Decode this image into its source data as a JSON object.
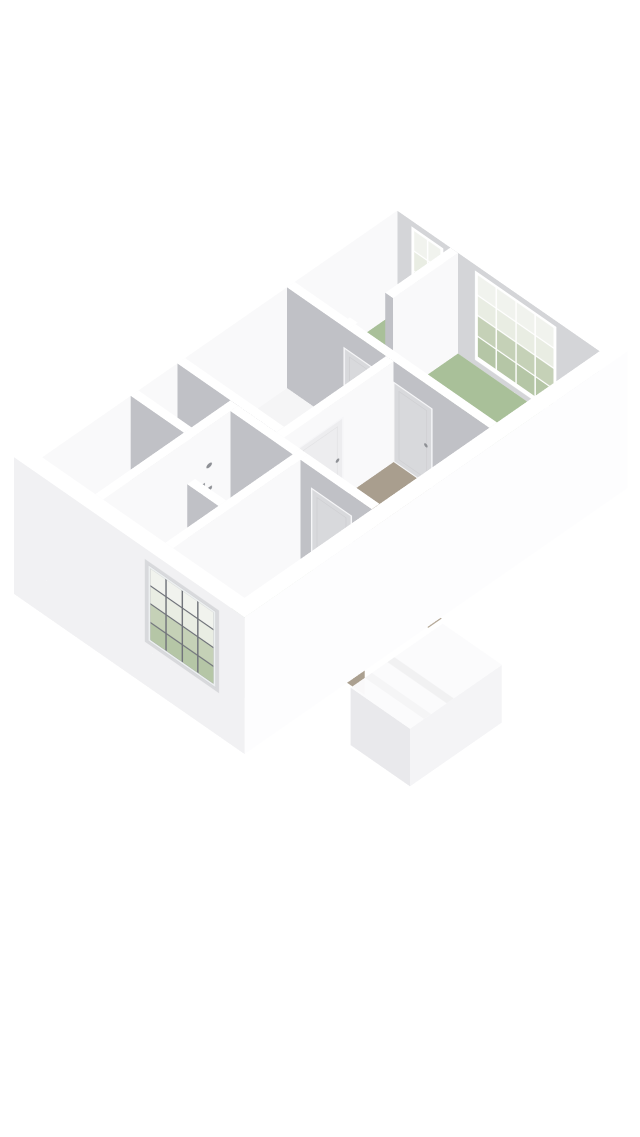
{
  "scene": {
    "type": "3d-floorplan-isometric-render",
    "background": "#ffffff",
    "level": "upper-floor"
  },
  "palette": {
    "page_bg": "#ffffff",
    "floor_white": "#f5f5f6",
    "floor_green": "#a9c099",
    "floor_beige": "#a99e8e",
    "step_a": "#aba090",
    "step_b": "#b6aa9a",
    "void_side": "#bfb5a7",
    "wall_top": "#ffffff",
    "wall_light": "#f9f9fa",
    "wall_gray": "#c0c1c6",
    "wall_gray_light": "#d4d5d8",
    "ext_se": "#fdfdfe",
    "ext_sw": "#f1f1f3",
    "door_light": "#ededef",
    "door_gray": "#d8d9dc",
    "door_frame": "#f6f6f8",
    "handle": "#8e9095",
    "muntin": "#ffffff",
    "muntin_dark": "#71747b",
    "glass_green": "#b5c6a6",
    "glass_green2": "#c5d1b7",
    "glass_light": "#e9ede3",
    "glass_light2": "#f1f3ee",
    "fixture": "#fcfdfd",
    "fixture_inner": "#eef1f2",
    "bulkhead_top": "#fbfbfc",
    "bulkhead_se": "#f4f4f6",
    "bulkhead_sw": "#e9e9ec"
  },
  "rooms": [
    {
      "id": "room-top-green",
      "floor": "green",
      "windows": 1
    },
    {
      "id": "room-right-green",
      "floor": "green",
      "windows": 1
    },
    {
      "id": "room-bottom-green",
      "floor": "green",
      "windows": 1
    },
    {
      "id": "room-top-left",
      "floor": "white"
    },
    {
      "id": "bathroom",
      "floor": "white",
      "fixtures": [
        "bathtub",
        "sink",
        "shower-mixer"
      ]
    },
    {
      "id": "hallway-landing",
      "floor": "beige",
      "features": [
        "staircase-down",
        "railing"
      ]
    },
    {
      "id": "storage-nook",
      "floor": "white"
    }
  ],
  "windows": [
    {
      "id": "window-ne-small",
      "wall": "northeast",
      "casements": 2,
      "panes_per_casement": 4,
      "muntins": "white"
    },
    {
      "id": "window-ne-large",
      "wall": "northeast",
      "casements": 4,
      "panes_per_casement": 4,
      "muntins": "white"
    },
    {
      "id": "window-sw-exterior",
      "wall": "southwest",
      "casements": 4,
      "panes_per_casement": 4,
      "muntins": "dark"
    }
  ],
  "doors": [
    {
      "id": "door-top-left-room",
      "state": "closed"
    },
    {
      "id": "door-right-room-north",
      "state": "closed"
    },
    {
      "id": "door-right-room-south",
      "state": "closed"
    },
    {
      "id": "door-bottom-room",
      "state": "closed"
    }
  ],
  "stairs": {
    "steps": 6,
    "railing_segments": 5,
    "direction": "descending-to-lower-floor"
  },
  "exterior": {
    "feature": "lower-level-stair-bulkhead"
  }
}
